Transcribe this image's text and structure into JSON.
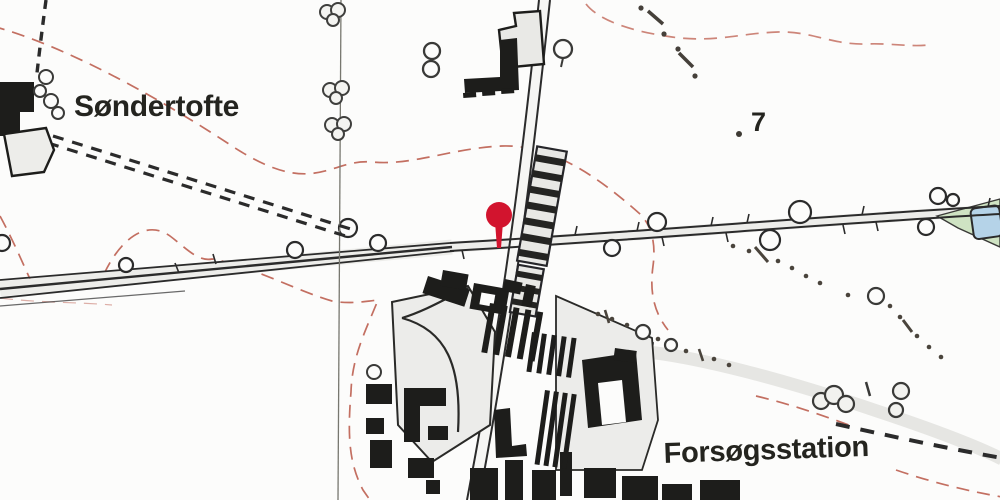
{
  "map": {
    "type": "historical-topographic-map",
    "labels": {
      "settlement": "Søndertofte",
      "station": "Forsøgsstation",
      "elevation_point": "7"
    },
    "marker": {
      "description": "red station location pin at level crossing",
      "color": "#d2142e"
    },
    "palette": {
      "background": "#fcfcfb",
      "ink": "#1d1d1b",
      "contour": "#bd5f50",
      "water": "#b5d3e8",
      "vegetation": "#cfe3c3",
      "road_fill": "#ececea"
    }
  }
}
